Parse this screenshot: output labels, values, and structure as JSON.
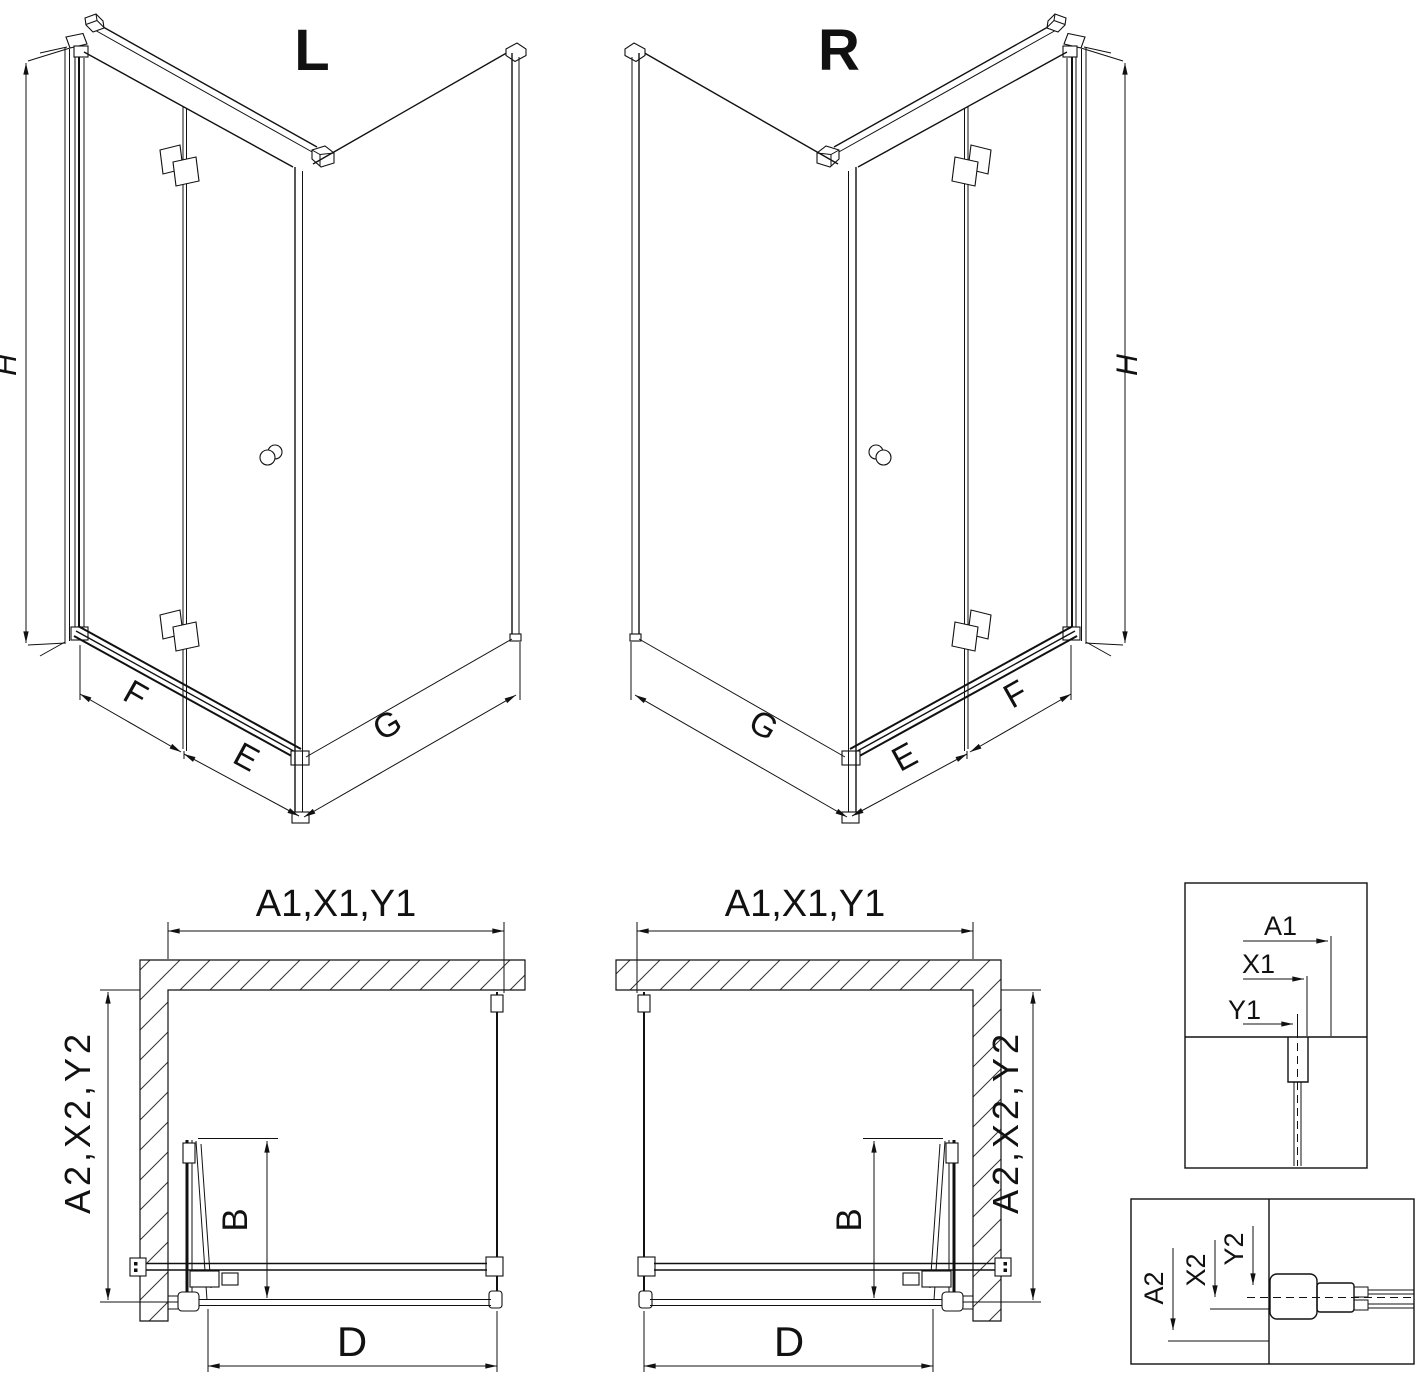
{
  "drawing": {
    "iso_left": {
      "title": "L",
      "dim_h": "H",
      "dim_f": "F",
      "dim_e": "E",
      "dim_g": "G"
    },
    "iso_right": {
      "title": "R",
      "dim_h": "H",
      "dim_f": "F",
      "dim_e": "E",
      "dim_g": "G"
    },
    "plan_left": {
      "dim_top": "A1,X1,Y1",
      "dim_side": "A2,X2,Y2",
      "dim_b": "B",
      "dim_d": "D"
    },
    "plan_right": {
      "dim_top": "A1,X1,Y1",
      "dim_side": "A2,X2,Y2",
      "dim_b": "B",
      "dim_d": "D"
    },
    "detail_top": {
      "dim_a1": "A1",
      "dim_x1": "X1",
      "dim_y1": "Y1"
    },
    "detail_bottom": {
      "dim_a2": "A2",
      "dim_x2": "X2",
      "dim_y2": "Y2"
    },
    "colors": {
      "line": "#111111",
      "background": "#ffffff"
    }
  }
}
